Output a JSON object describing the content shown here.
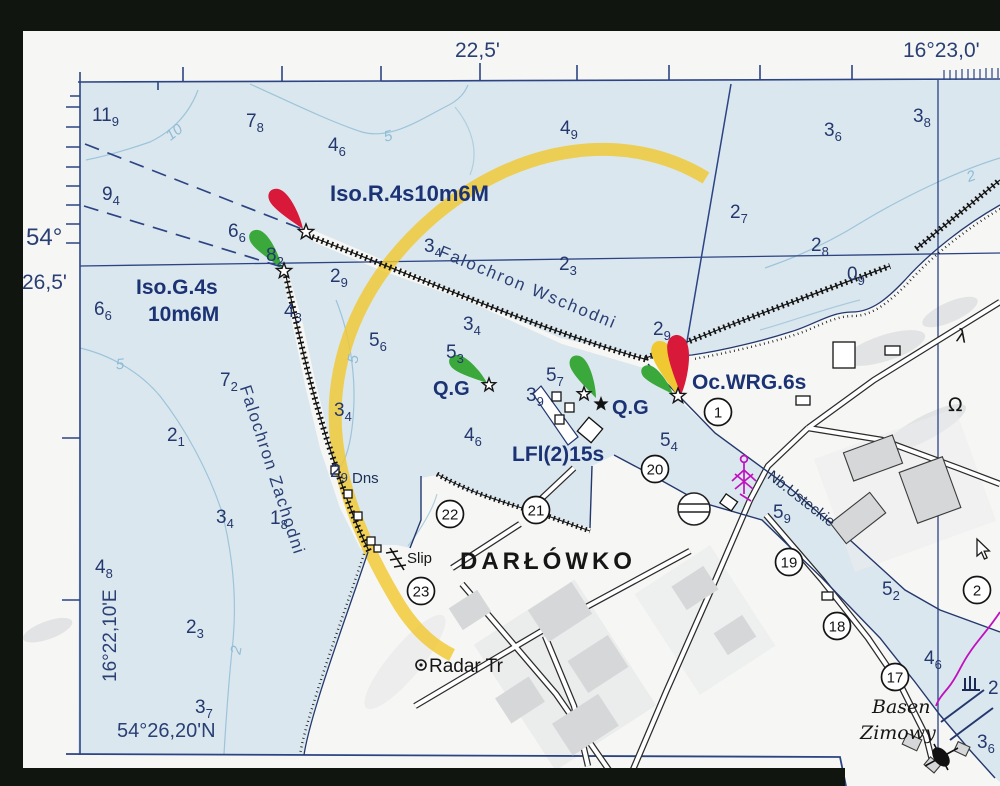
{
  "colors": {
    "navy_ink": "#24386e",
    "black_ink": "#161616",
    "water": "#dbe7ee",
    "contour_blue": "#9dc4da",
    "sector_yellow": "#f0c832",
    "light_red": "#d81939",
    "light_green": "#3aa83a",
    "magenta": "#c011c0",
    "building_gray": "#d5d7d9",
    "paper": "#f6f7f4"
  },
  "axis": {
    "top_minutes": "22,5'",
    "top_longitude": "16°23,0'",
    "left_degrees": "54°",
    "left_minutes": "26,5'",
    "corner_longitude": "16°22,10'E",
    "corner_latitude": "54°26,20'N"
  },
  "lights": {
    "iso_r": "Iso.R.4s10m6M",
    "iso_g_line1": "Iso.G.4s",
    "iso_g_line2": "10m6M",
    "oc_wrg": "Oc.WRG.6s",
    "qg_west": "Q.G",
    "qg_east": "Q.G",
    "lfl": "LFl(2)15s"
  },
  "places": {
    "town": "DARŁÓWKO",
    "east_breakwater": "Falochron Wschodni",
    "west_breakwater": "Falochron Zachodni",
    "dolphins": "Dns",
    "slip": "Slip",
    "radar_tower": "Radar Tr",
    "quay": "Nb.Usteckie",
    "basin_line1": "Basen",
    "basin_line2": "Zimowy"
  },
  "soundings": [
    [
      92,
      107,
      "11",
      "9"
    ],
    [
      246,
      113,
      "7",
      "8"
    ],
    [
      328,
      137,
      "4",
      "6"
    ],
    [
      102,
      186,
      "9",
      "4"
    ],
    [
      560,
      120,
      "4",
      "9"
    ],
    [
      824,
      122,
      "3",
      "6"
    ],
    [
      913,
      108,
      "3",
      "8"
    ],
    [
      730,
      204,
      "2",
      "7"
    ],
    [
      811,
      237,
      "2",
      "8"
    ],
    [
      847,
      266,
      "0",
      "9"
    ],
    [
      228,
      223,
      "6",
      "6"
    ],
    [
      266,
      247,
      "8",
      "2"
    ],
    [
      94,
      301,
      "6",
      "6"
    ],
    [
      330,
      268,
      "2",
      "9"
    ],
    [
      424,
      238,
      "3",
      "4"
    ],
    [
      559,
      256,
      "2",
      "3"
    ],
    [
      653,
      321,
      "2",
      "9"
    ],
    [
      284,
      303,
      "4",
      "3"
    ],
    [
      369,
      332,
      "5",
      "6"
    ],
    [
      463,
      316,
      "3",
      "4"
    ],
    [
      446,
      344,
      "5",
      "3"
    ],
    [
      546,
      367,
      "5",
      "7"
    ],
    [
      526,
      387,
      "3",
      "9"
    ],
    [
      220,
      372,
      "7",
      "2"
    ],
    [
      167,
      427,
      "2",
      "1"
    ],
    [
      334,
      402,
      "3",
      "4"
    ],
    [
      330,
      463,
      "2",
      "9"
    ],
    [
      464,
      427,
      "4",
      "6"
    ],
    [
      216,
      509,
      "3",
      "4"
    ],
    [
      270,
      510,
      "1",
      "8"
    ],
    [
      660,
      432,
      "5",
      "4"
    ],
    [
      773,
      504,
      "5",
      "9"
    ],
    [
      882,
      581,
      "5",
      "2"
    ],
    [
      924,
      650,
      "4",
      "6"
    ],
    [
      977,
      734,
      "3",
      "6"
    ],
    [
      95,
      559,
      "4",
      "8"
    ],
    [
      186,
      619,
      "2",
      "3"
    ],
    [
      195,
      699,
      "3",
      "7"
    ],
    [
      988,
      680,
      "2",
      ""
    ]
  ],
  "berth_numbers": [
    [
      718,
      412,
      "1"
    ],
    [
      655,
      469,
      "20"
    ],
    [
      536,
      510,
      "21"
    ],
    [
      450,
      514,
      "22"
    ],
    [
      421,
      591,
      "23"
    ],
    [
      789,
      562,
      "19"
    ],
    [
      837,
      626,
      "18"
    ],
    [
      895,
      677,
      "17"
    ],
    [
      977,
      590,
      "2"
    ]
  ],
  "contour_labels": [
    [
      174,
      132,
      "10",
      -38
    ],
    [
      388,
      136,
      "5",
      -15
    ],
    [
      120,
      364,
      "5",
      -5
    ],
    [
      353,
      359,
      "5",
      -80
    ],
    [
      971,
      176,
      "2",
      -20
    ],
    [
      236,
      650,
      "2",
      -80
    ]
  ],
  "symbols": {
    "omega": "Ω",
    "lambda": "λ"
  }
}
